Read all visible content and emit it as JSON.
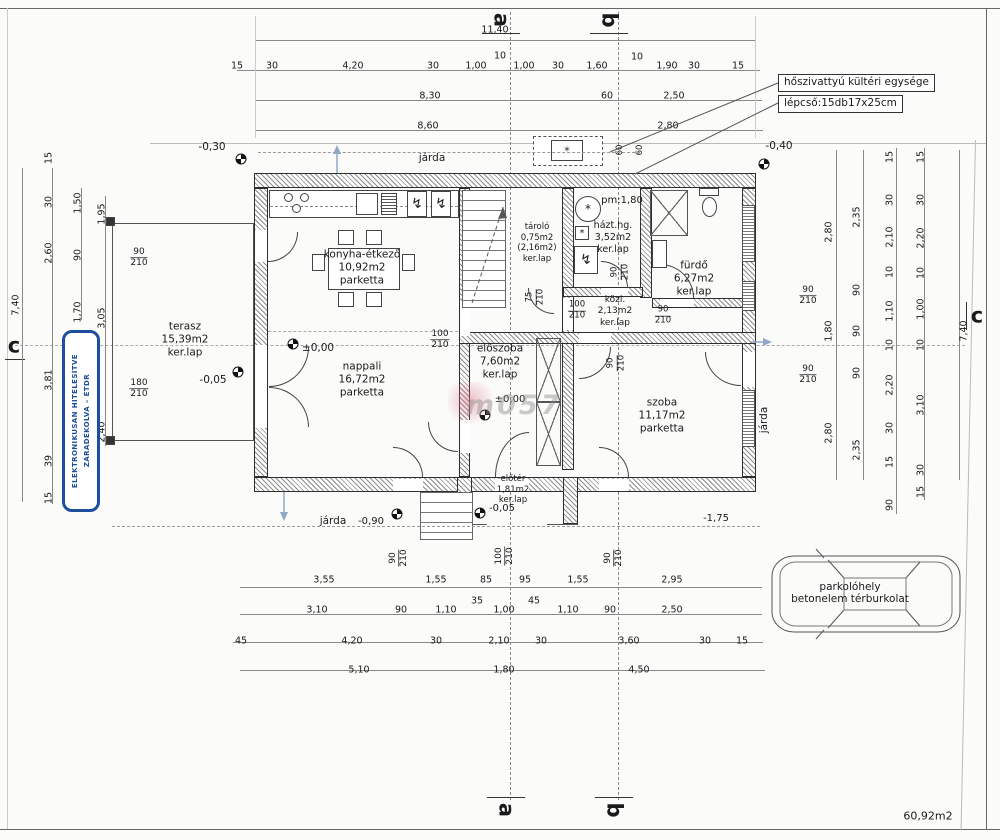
{
  "rooms": {
    "konyha": {
      "name": "konyha-étkező",
      "area": "10,92m2",
      "floor": "parketta"
    },
    "terasz": {
      "name": "terasz",
      "area": "15,39m2",
      "floor": "ker.lap"
    },
    "nappali": {
      "name": "nappali",
      "area": "16,72m2",
      "floor": "parketta"
    },
    "eloszoba": {
      "name": "előszoba",
      "area": "7,60m2",
      "floor": "ker.lap"
    },
    "tarolo": {
      "name": "tároló",
      "area": "0,75m2",
      "area2": "(2,16m2)",
      "floor": "ker.lap"
    },
    "hazthg": {
      "name": "házt.hg.",
      "area": "3,52m2",
      "floor": "ker.lap"
    },
    "furdo": {
      "name": "fürdő",
      "area": "6,27m2",
      "floor": "ker.lap"
    },
    "kozl": {
      "name": "közl.",
      "area": "2,13m2",
      "floor": "ker.lap"
    },
    "szoba": {
      "name": "szoba",
      "area": "11,17m2",
      "floor": "parketta"
    },
    "eloter": {
      "name": "előtér",
      "area": "1,81m2",
      "floor": "ker.lap"
    }
  },
  "levels": {
    "l030": "-0,30",
    "l040": "-0,40",
    "zero": "±0,00",
    "l005": "-0,05",
    "l090": "-0,90",
    "l175": "-1,75"
  },
  "sections": {
    "a": "a",
    "b": "b",
    "c": "c"
  },
  "notes": {
    "heat_pump": "hőszivattyú kültéri egysége",
    "stairs": "lépcső:15db17x25cm",
    "pm": "pm:1,80",
    "jarda": "járda",
    "parking_line1": "parkolóhely",
    "parking_line2": "betonelem térburkolat",
    "total_area": "60,92m2",
    "watermark": "m057"
  },
  "stamp": {
    "line1": "ELEKTRONIKUSAN HITELESÍTVE",
    "line2": "ZÁRADÉKOLVA – ÉTDR"
  },
  "doors": {
    "w60": "60",
    "w75": "75",
    "w90": "90",
    "w100": "100",
    "w180": "180",
    "h210": "210"
  },
  "colors": {
    "stamp_blue": "#1d4f9e",
    "slope_arrow_blue": "#8fa8c8"
  },
  "dims": {
    "top": {
      "overall": "11,40",
      "row2": [
        "15",
        "30",
        "4,20",
        "30",
        "1,00",
        "10",
        "1,00",
        "30",
        "1,60",
        "10",
        "1,90",
        "30",
        "15"
      ],
      "row3": [
        "8,30",
        "60",
        "2,50"
      ],
      "row4": [
        "8,60",
        "2,80"
      ]
    },
    "left": {
      "overall": "7,40",
      "chain1": [
        "15",
        "30",
        "2,60",
        "3,81",
        "39",
        "15"
      ],
      "chain2": [
        "1,50",
        "90",
        "1,70"
      ],
      "chain3": [
        "1,95",
        "3,05",
        "2,40"
      ]
    },
    "right": {
      "overall": "7,40",
      "chain1": [
        "2,80",
        "1,80",
        "2,80"
      ],
      "chain2": [
        "2,35",
        "90",
        "90",
        "90",
        "2,35"
      ],
      "chain3": [
        "15",
        "30",
        "2,10",
        "10",
        "1,10",
        "10",
        "2,20",
        "30",
        "15",
        "90"
      ],
      "chain4": [
        "15",
        "30",
        "2,20",
        "10",
        "1,00",
        "10",
        "3,10",
        "30",
        "15"
      ]
    },
    "bottom": {
      "row1": [
        "3,55",
        "1,55",
        "85",
        "95",
        "1,55",
        "2,95"
      ],
      "row2": [
        "3,10",
        "90",
        "1,10",
        "35",
        "1,00",
        "45",
        "1,10",
        "90",
        "2,50"
      ],
      "row3": [
        "45",
        "4,20",
        "30",
        "2,10",
        "30",
        "3,60",
        "30",
        "15"
      ],
      "row4": [
        "5,10",
        "1,80",
        "4,50"
      ]
    }
  }
}
